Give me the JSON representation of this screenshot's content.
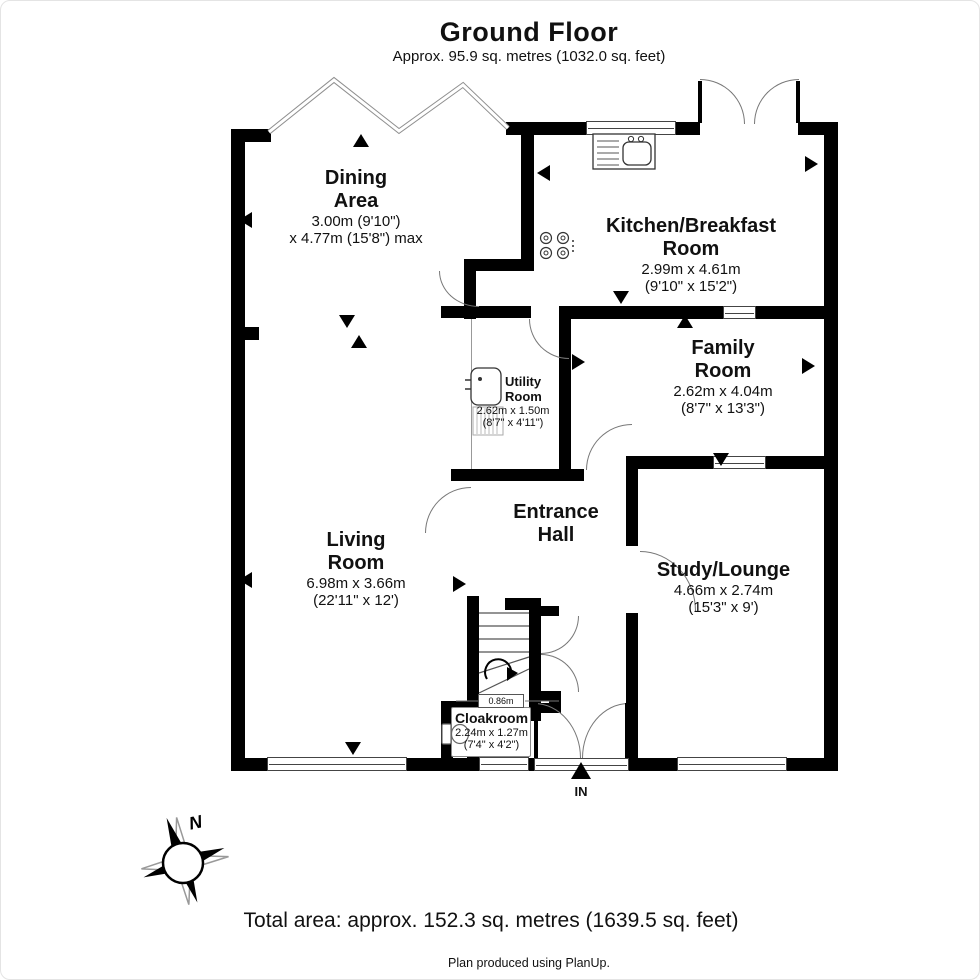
{
  "header": {
    "title": "Ground Floor",
    "subtitle": "Approx. 95.9 sq. metres (1032.0 sq. feet)"
  },
  "rooms": {
    "dining": {
      "name1": "Dining",
      "name2": "Area",
      "dim1": "3.00m (9'10\")",
      "dim2": "x 4.77m (15'8\") max"
    },
    "kitchen": {
      "name1": "Kitchen/Breakfast",
      "name2": "Room",
      "dim1": "2.99m x 4.61m",
      "dim2": "(9'10\" x 15'2\")"
    },
    "family": {
      "name1": "Family",
      "name2": "Room",
      "dim1": "2.62m x 4.04m",
      "dim2": "(8'7\" x 13'3\")"
    },
    "utility": {
      "name1": "Utility",
      "name2": "Room",
      "dim1": "2.62m x 1.50m",
      "dim2": "(8'7\" x 4'11\")"
    },
    "entrance": {
      "name1": "Entrance",
      "name2": "Hall"
    },
    "living": {
      "name1": "Living",
      "name2": "Room",
      "dim1": "6.98m x 3.66m",
      "dim2": "(22'11\" x 12')"
    },
    "study": {
      "name": "Study/Lounge",
      "dim1": "4.66m x 2.74m",
      "dim2": "(15'3\" x 9')"
    },
    "cloakroom": {
      "name": "Cloakroom",
      "dim1": "2.24m x 1.27m",
      "dim2": "(7'4\" x 4'2\")"
    }
  },
  "annotations": {
    "stair_width": "0.86m",
    "entrance_label": "IN",
    "compass_north": "N"
  },
  "footer": {
    "total_area": "Total area: approx. 152.3 sq. metres (1639.5 sq. feet)",
    "credit": "Plan produced using PlanUp."
  },
  "colors": {
    "wall": "#000000",
    "door_arc": "#777777",
    "text": "#111111"
  }
}
